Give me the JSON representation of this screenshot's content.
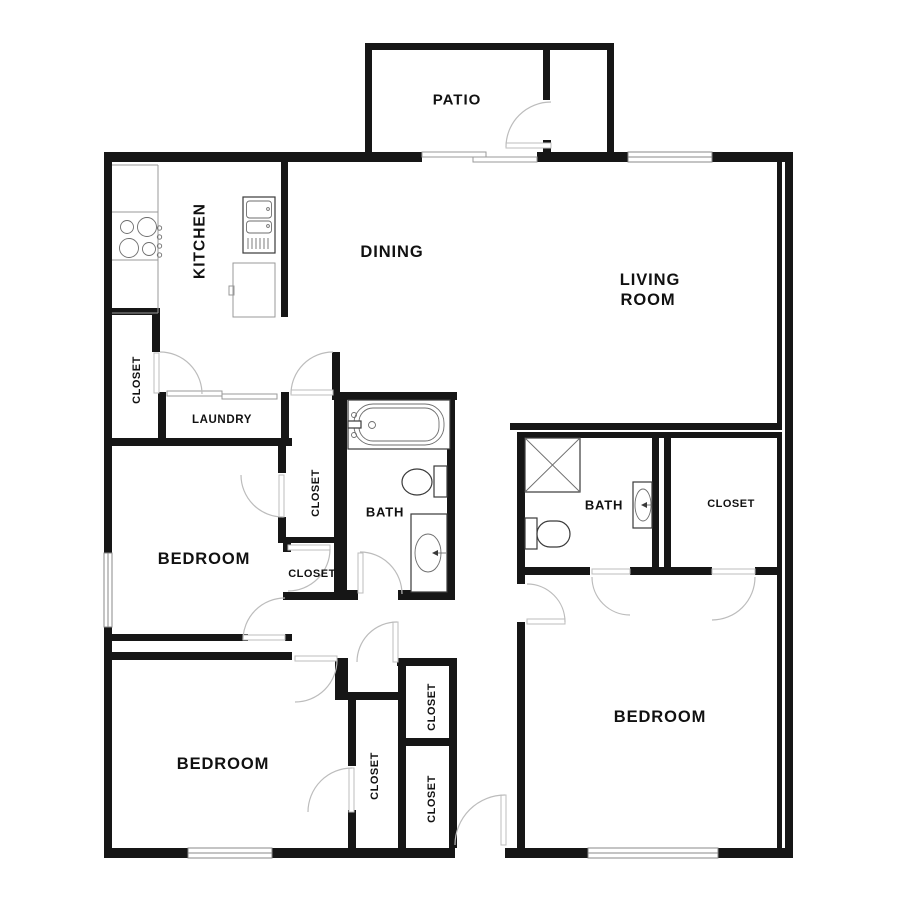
{
  "labels": {
    "patio": "PATIO",
    "kitchen": "KITCHEN",
    "dining": "DINING",
    "living_line1": "LIVING",
    "living_line2": "ROOM",
    "closet_hall": "CLOSET",
    "laundry": "LAUNDRY",
    "bath_left": "BATH",
    "closet_bedroom1_top": "CLOSET",
    "closet_bedroom1_bottom": "CLOSET",
    "bedroom_left": "BEDROOM",
    "bath_right": "BATH",
    "closet_bath_right": "CLOSET",
    "bedroom_right": "BEDROOM",
    "bedroom_bottom_left": "BEDROOM",
    "closet_center_top": "CLOSET",
    "closet_bedroom_bottom_left": "CLOSET",
    "closet_center_bottom": "CLOSET"
  },
  "fixtures": [
    "stove",
    "refrigerator",
    "kitchen-cabinet",
    "bathtub",
    "toilet",
    "vanity-sink",
    "shower"
  ],
  "colors": {
    "wall": "#161616",
    "door_arc": "#bcbcbc",
    "window_frame": "#888888",
    "counter_line": "#999999",
    "label_text": "#111111",
    "background": "#ffffff"
  }
}
